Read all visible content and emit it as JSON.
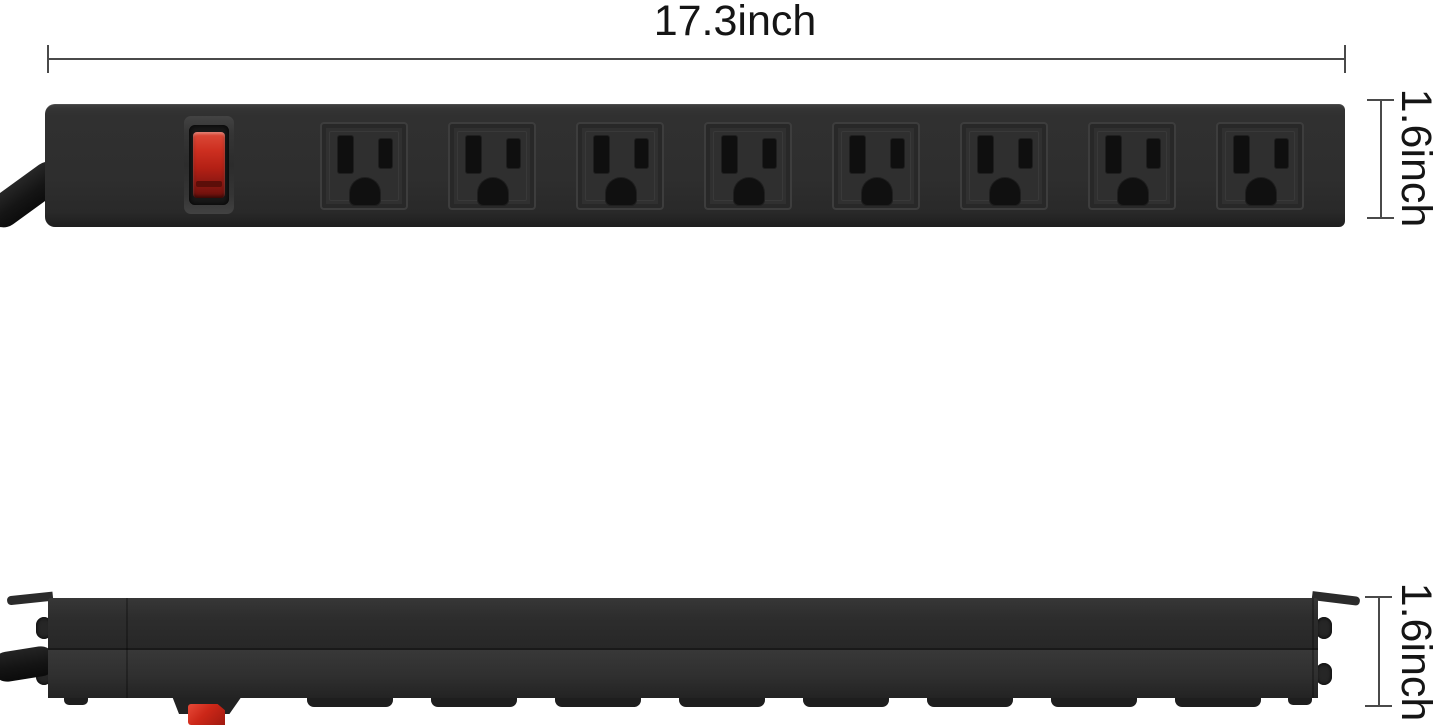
{
  "dimension_labels": {
    "width": "17.3inch",
    "front_height": "1.6inch",
    "side_height": "1.6inch"
  },
  "product": {
    "outlet_count": 8,
    "foot_count": 8
  },
  "colors": {
    "background": "#ffffff",
    "strip_body": "#2e2e2e",
    "switch_red": "#c52a1c",
    "dimension_line": "#4a4a4a",
    "label_text": "#151515"
  }
}
